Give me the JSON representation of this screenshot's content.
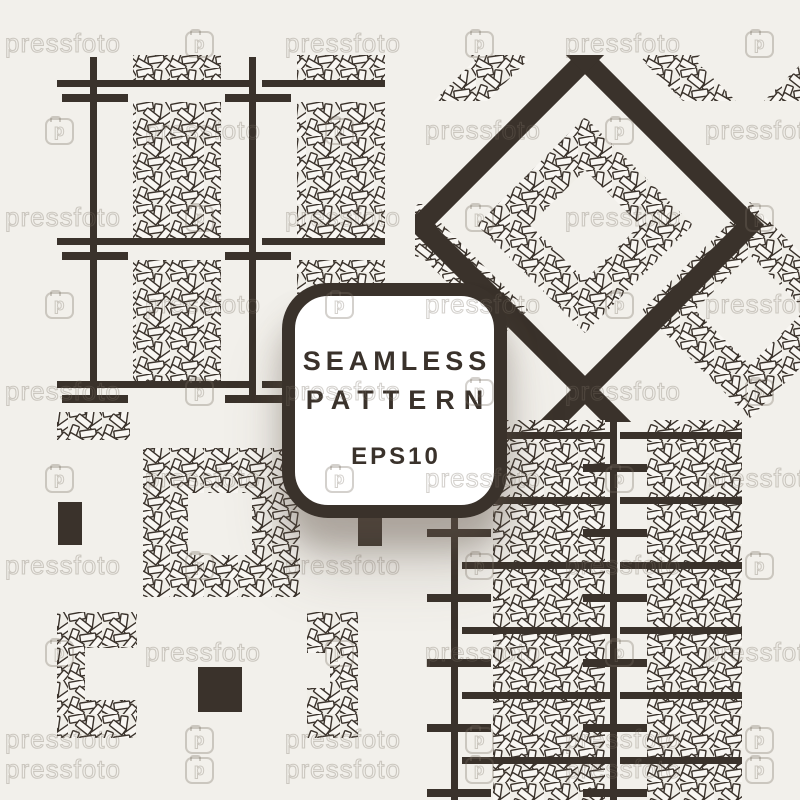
{
  "theme": {
    "background": "#f2f0eb",
    "ink": "#3a322b",
    "paper": "#f8f6f2",
    "weave_bg": "#f0eee8",
    "badge_bg": "#ffffff",
    "watermark_color": "rgba(122,112,100,0.32)"
  },
  "badge": {
    "title_line1": "SEAMLESS",
    "title_line2": "PATTERN",
    "subtitle": "EPS10"
  },
  "watermark": {
    "text": "pressfoto",
    "logo_letter": "p",
    "rows": [
      {
        "y": 44,
        "offset": "A"
      },
      {
        "y": 131,
        "offset": "B"
      },
      {
        "y": 218,
        "offset": "A"
      },
      {
        "y": 305,
        "offset": "B"
      },
      {
        "y": 392,
        "offset": "A"
      },
      {
        "y": 479,
        "offset": "B"
      },
      {
        "y": 566,
        "offset": "A"
      },
      {
        "y": 653,
        "offset": "B"
      },
      {
        "y": 740,
        "offset": "A"
      },
      {
        "y": 770,
        "offset": "A"
      }
    ],
    "offsets": {
      "A": {
        "texts": [
          5,
          285,
          565
        ],
        "icons": [
          185,
          465,
          745
        ]
      },
      "B": {
        "texts": [
          -135,
          145,
          425,
          705
        ],
        "icons": [
          45,
          325,
          605
        ]
      }
    }
  }
}
